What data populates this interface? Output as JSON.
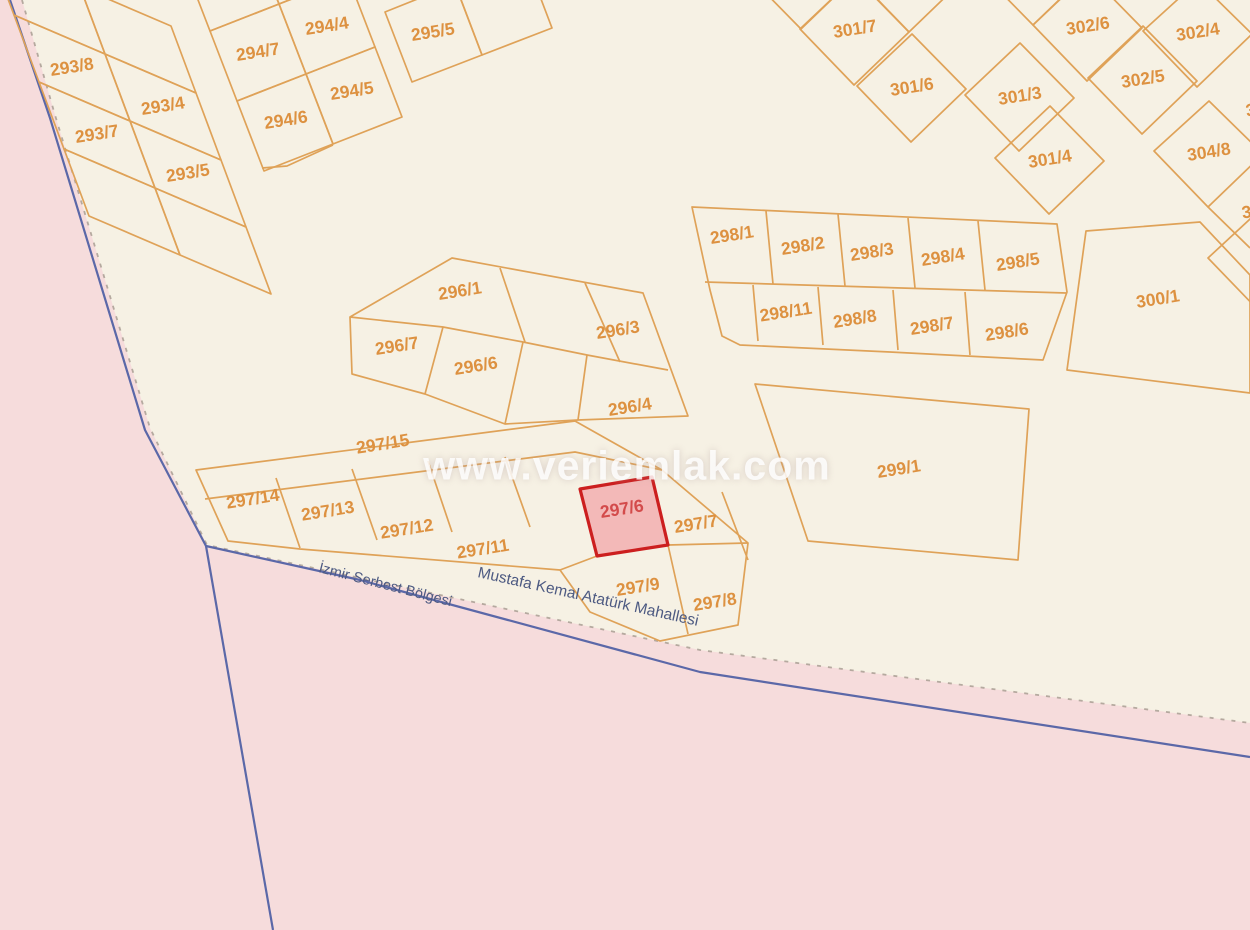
{
  "map": {
    "watermark": "www.veriemlak.com",
    "highlighted_parcel": "297/6",
    "street_labels": [
      {
        "text": "İzmir Serbest Bölgesi",
        "x": 318,
        "y": 572,
        "rotation": 14.5,
        "size": 14.5
      },
      {
        "text": "Mustafa Kemal Atatürk Mahallesi",
        "x": 477,
        "y": 577,
        "rotation": 12.5,
        "size": 15.5
      }
    ],
    "parcel_labels": [
      {
        "text": "293/8",
        "x": 72,
        "y": 68
      },
      {
        "text": "293/4",
        "x": 163,
        "y": 107
      },
      {
        "text": "293/7",
        "x": 97,
        "y": 135
      },
      {
        "text": "293/5",
        "x": 188,
        "y": 174
      },
      {
        "text": "294/7",
        "x": 258,
        "y": 53
      },
      {
        "text": "294/4",
        "x": 327,
        "y": 27
      },
      {
        "text": "294/6",
        "x": 286,
        "y": 121
      },
      {
        "text": "294/5",
        "x": 352,
        "y": 92
      },
      {
        "text": "295/5",
        "x": 433,
        "y": 33
      },
      {
        "text": "301/7",
        "x": 855,
        "y": 30
      },
      {
        "text": "301/6",
        "x": 912,
        "y": 88
      },
      {
        "text": "301/3",
        "x": 1020,
        "y": 97
      },
      {
        "text": "301/4",
        "x": 1050,
        "y": 160
      },
      {
        "text": "302/6",
        "x": 1088,
        "y": 27
      },
      {
        "text": "302/4",
        "x": 1198,
        "y": 33
      },
      {
        "text": "302/5",
        "x": 1143,
        "y": 80
      },
      {
        "text": "304/8",
        "x": 1209,
        "y": 153
      },
      {
        "text": "300/1",
        "x": 1158,
        "y": 300
      },
      {
        "text": "298/1",
        "x": 732,
        "y": 236
      },
      {
        "text": "298/2",
        "x": 803,
        "y": 247
      },
      {
        "text": "298/3",
        "x": 872,
        "y": 253
      },
      {
        "text": "298/4",
        "x": 943,
        "y": 258
      },
      {
        "text": "298/5",
        "x": 1018,
        "y": 263
      },
      {
        "text": "298/11",
        "x": 786,
        "y": 313
      },
      {
        "text": "298/8",
        "x": 855,
        "y": 320
      },
      {
        "text": "298/7",
        "x": 932,
        "y": 327
      },
      {
        "text": "298/6",
        "x": 1007,
        "y": 333
      },
      {
        "text": "296/1",
        "x": 460,
        "y": 292
      },
      {
        "text": "296/3",
        "x": 618,
        "y": 331
      },
      {
        "text": "296/7",
        "x": 397,
        "y": 347
      },
      {
        "text": "296/6",
        "x": 476,
        "y": 367
      },
      {
        "text": "296/4",
        "x": 630,
        "y": 408
      },
      {
        "text": "297/15",
        "x": 383,
        "y": 445
      },
      {
        "text": "297/14",
        "x": 253,
        "y": 500
      },
      {
        "text": "297/13",
        "x": 328,
        "y": 512
      },
      {
        "text": "297/12",
        "x": 407,
        "y": 530
      },
      {
        "text": "297/11",
        "x": 483,
        "y": 550
      },
      {
        "text": "297/6",
        "x": 622,
        "y": 510,
        "highlighted": true
      },
      {
        "text": "297/7",
        "x": 696,
        "y": 525
      },
      {
        "text": "297/9",
        "x": 638,
        "y": 588
      },
      {
        "text": "297/8",
        "x": 715,
        "y": 603
      },
      {
        "text": "299/1",
        "x": 899,
        "y": 470
      }
    ],
    "edge_partial_labels": [
      {
        "text": "3",
        "x": 1246,
        "y": 112
      },
      {
        "text": "30",
        "x": 1242,
        "y": 214
      }
    ],
    "colors": {
      "land_cream": "#f6f1e4",
      "zone_pink": "#f6dcdc",
      "parcel_line_orange": "#dfa258",
      "parcel_label_orange": "#dd9140",
      "highlight_red": "#cc1f1f",
      "highlight_fill": "#f2b4b4",
      "boundary_blue": "#5b68a8",
      "street_text": "#4d5a82"
    }
  }
}
